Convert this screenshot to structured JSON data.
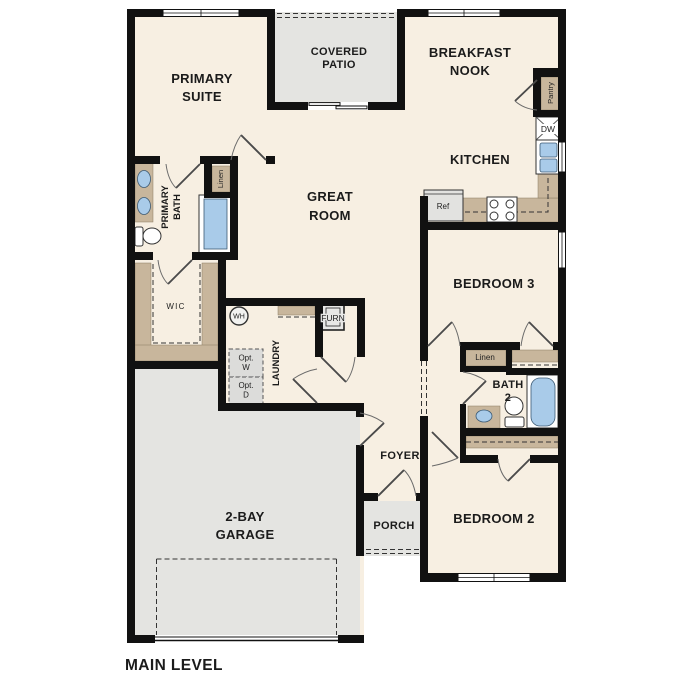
{
  "plan": {
    "level_label": "MAIN LEVEL",
    "rooms": {
      "primary_suite": {
        "line1": "PRIMARY",
        "line2": "SUITE"
      },
      "covered_patio": {
        "line1": "COVERED",
        "line2": "PATIO"
      },
      "breakfast_nook": {
        "line1": "BREAKFAST",
        "line2": "NOOK"
      },
      "kitchen": {
        "label": "KITCHEN"
      },
      "great_room": {
        "line1": "GREAT",
        "line2": "ROOM"
      },
      "primary_bath": {
        "line1": "PRIMARY",
        "line2": "BATH"
      },
      "wic": {
        "label": "WIC"
      },
      "laundry": {
        "label": "LAUNDRY"
      },
      "foyer": {
        "label": "FOYER"
      },
      "porch": {
        "label": "PORCH"
      },
      "garage": {
        "line1": "2-BAY",
        "line2": "GARAGE"
      },
      "bedroom3": {
        "label": "BEDROOM 3"
      },
      "bedroom2": {
        "label": "BEDROOM 2"
      },
      "bath2": {
        "line1": "BATH",
        "line2": "2"
      }
    },
    "closets": {
      "pantry": "Pantry",
      "linen_primary": "Linen",
      "linen_hall": "Linen"
    },
    "equipment": {
      "water_heater": "WH",
      "furnace": "FURN",
      "dishwasher": "DW",
      "refrigerator": "Ref",
      "opt_washer": {
        "line1": "Opt.",
        "line2": "W"
      },
      "opt_dryer": {
        "line1": "Opt.",
        "line2": "D"
      }
    },
    "colors": {
      "floor": "#f7efe2",
      "outdoor": "#e4e4e1",
      "casework": "#c8b69c",
      "fixture_blue": "#a9cbe9",
      "wall": "#111111"
    }
  }
}
